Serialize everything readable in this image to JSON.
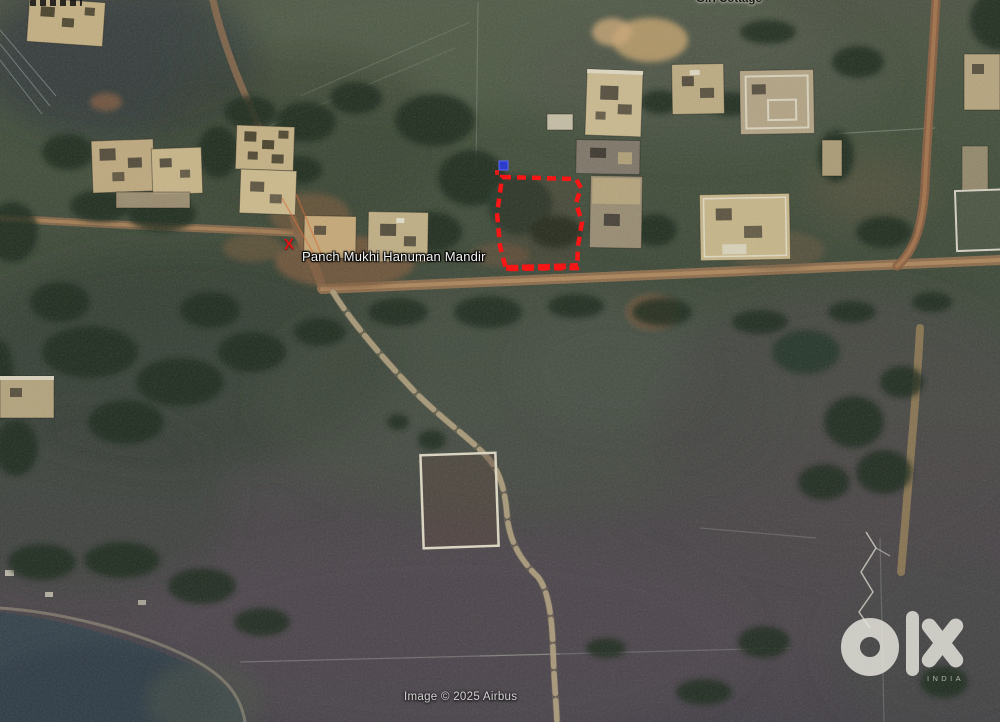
{
  "map": {
    "place_labels": {
      "mandir": "Panch Mukhi Hanuman Mandir",
      "cottage": "Giri Cottage"
    },
    "markers": {
      "x_glyph": "X"
    },
    "annotation_colors": {
      "plot_outline": "#fe0a0a",
      "pin": "#2233cc",
      "x_marker": "#e51212"
    },
    "attribution": "Image © 2025 Airbus"
  },
  "watermark": {
    "brand": "olx",
    "region": "INDIA"
  }
}
